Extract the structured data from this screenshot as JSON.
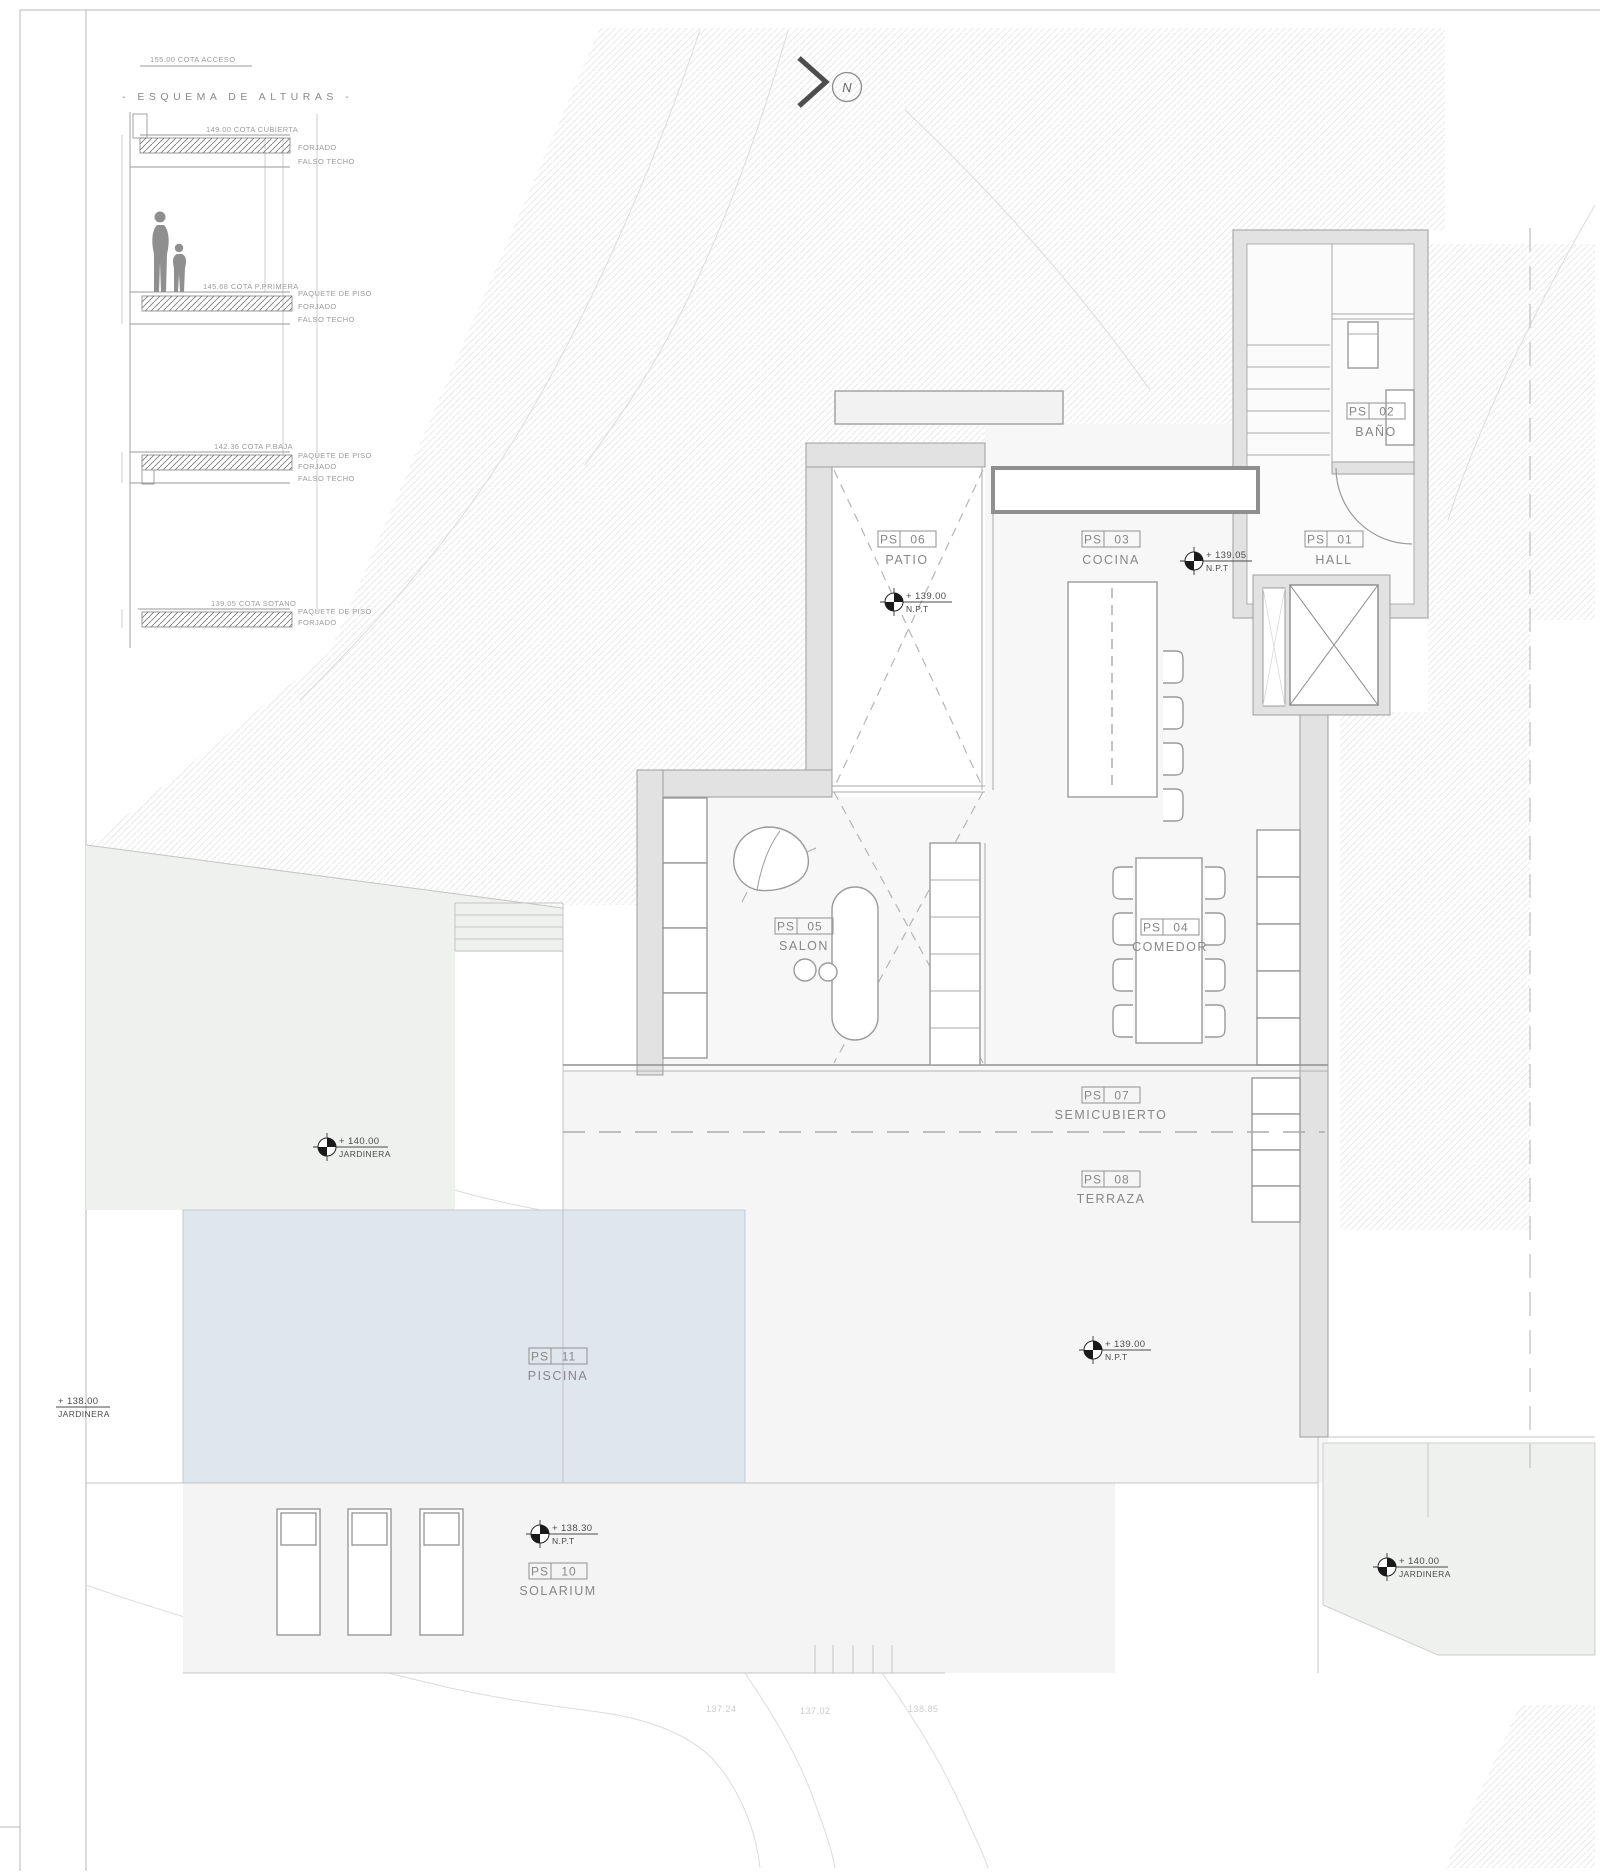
{
  "sheet": {
    "contour_labels": [
      "137.24",
      "137.02",
      "138.85"
    ]
  },
  "north": {
    "label": "N"
  },
  "esquema": {
    "access": "155.00 COTA ACCESO",
    "title": "- ESQUEMA DE ALTURAS -",
    "levels": {
      "cubierta": {
        "cota": "149.00 COTA CUBIERTA",
        "l1": "FORJADO",
        "l2": "FALSO TECHO"
      },
      "primera": {
        "cota": "145.68 COTA P.PRIMERA",
        "l1": "PAQUETE DE PISO",
        "l2": "FORJADO",
        "l3": "FALSO TECHO"
      },
      "baja": {
        "cota": "142.36 COTA P.BAJA",
        "l1": "PAQUETE DE PISO",
        "l2": "FORJADO",
        "l3": "FALSO TECHO"
      },
      "sotano": {
        "cota": "139.05 COTA SOTANO",
        "l1": "PAQUETE DE PISO",
        "l2": "FORJADO"
      }
    }
  },
  "rooms": {
    "hall": {
      "code": "PS",
      "num": "01",
      "name": "HALL"
    },
    "bano": {
      "code": "PS",
      "num": "02",
      "name": "BAÑO"
    },
    "cocina": {
      "code": "PS",
      "num": "03",
      "name": "COCINA"
    },
    "comedor": {
      "code": "PS",
      "num": "04",
      "name": "COMEDOR"
    },
    "salon": {
      "code": "PS",
      "num": "05",
      "name": "SALON"
    },
    "patio": {
      "code": "PS",
      "num": "06",
      "name": "PATIO"
    },
    "semicubierto": {
      "code": "PS",
      "num": "07",
      "name": "SEMICUBIERTO"
    },
    "terraza": {
      "code": "PS",
      "num": "08",
      "name": "TERRAZA"
    },
    "solarium": {
      "code": "PS",
      "num": "10",
      "name": "SOLARIUM"
    },
    "piscina": {
      "code": "PS",
      "num": "11",
      "name": "PISCINA"
    }
  },
  "markers": {
    "hall_npt": {
      "value": "+ 139.05",
      "sub": "N.P.T"
    },
    "patio_npt": {
      "value": "+ 139.00",
      "sub": "N.P.T"
    },
    "jardinera_left": {
      "value": "+ 140.00",
      "sub": "JARDINERA"
    },
    "jardinera_west": {
      "value": "+ 138.00",
      "sub": "JARDINERA"
    },
    "terraza_npt": {
      "value": "+ 139.00",
      "sub": "N.P.T"
    },
    "solarium_npt": {
      "value": "+ 138.30",
      "sub": "N.P.T"
    },
    "jardinera_br": {
      "value": "+ 140.00",
      "sub": "JARDINERA"
    }
  },
  "colors": {
    "pool": "#dfe6ec",
    "wall": "#e2e2e2",
    "terrain_hatch": "#e9e9e9"
  }
}
